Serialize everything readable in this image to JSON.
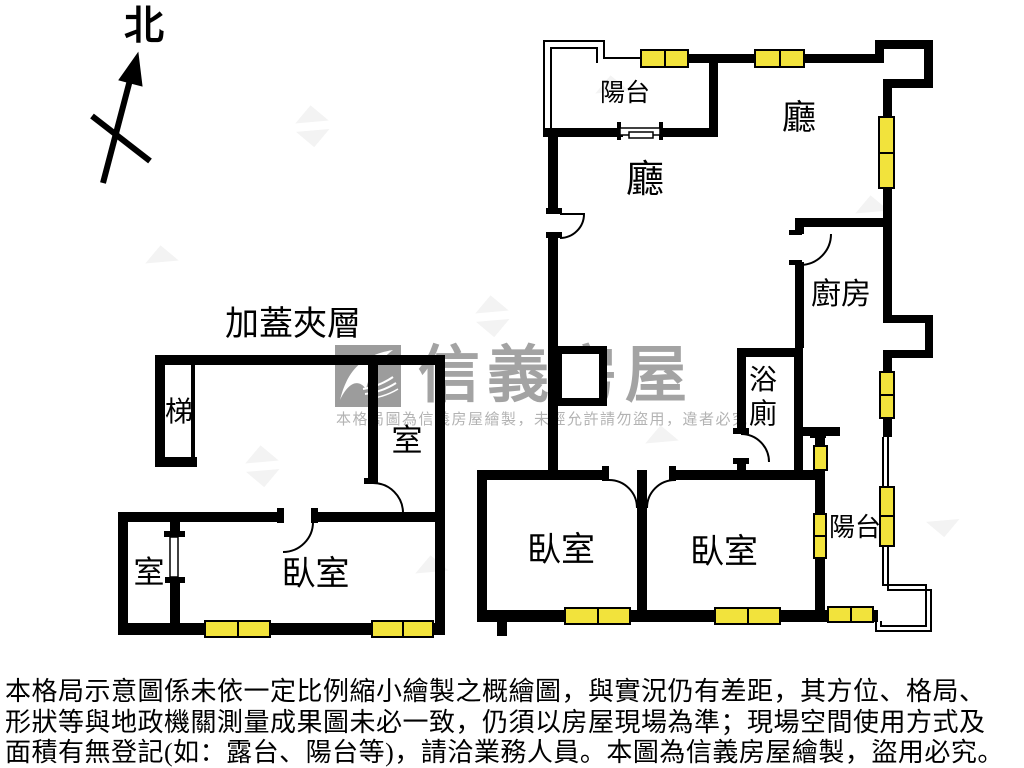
{
  "compass": {
    "label": "北"
  },
  "watermark": {
    "brand": "信義房屋",
    "disclaimer": "本格局圖為信義房屋繪製，未經允許請勿盜用，違者必究",
    "logo_color": "#9c9c9c",
    "text_color": "#a3a3a3"
  },
  "plan": {
    "colors": {
      "wall": "#000000",
      "window": "#f2e33c"
    },
    "labels": {
      "balcony_top": "陽台",
      "hall_left": "廳",
      "hall_right": "廳",
      "kitchen": "廚房",
      "stairs_main": "梯",
      "bathroom": "浴廁",
      "bedroom_left": "臥室",
      "bedroom_right": "臥室",
      "balcony_right": "陽台",
      "mezzanine_title": "加蓋夾層",
      "stairs_mezz": "梯",
      "room_mezz": "室",
      "room_lower": "室",
      "bedroom_lower": "臥室"
    }
  },
  "footer": {
    "lines": [
      "本格局示意圖係未依一定比例縮小繪製之概繪圖，與實況仍有差距，其方位、格局、",
      "形狀等與地政機關測量成果圖未必一致，仍須以房屋現場為準；現場空間使用方式及",
      "面積有無登記(如：露台、陽台等)，請洽業務人員。本圖為信義房屋繪製，盜用必究。"
    ]
  }
}
